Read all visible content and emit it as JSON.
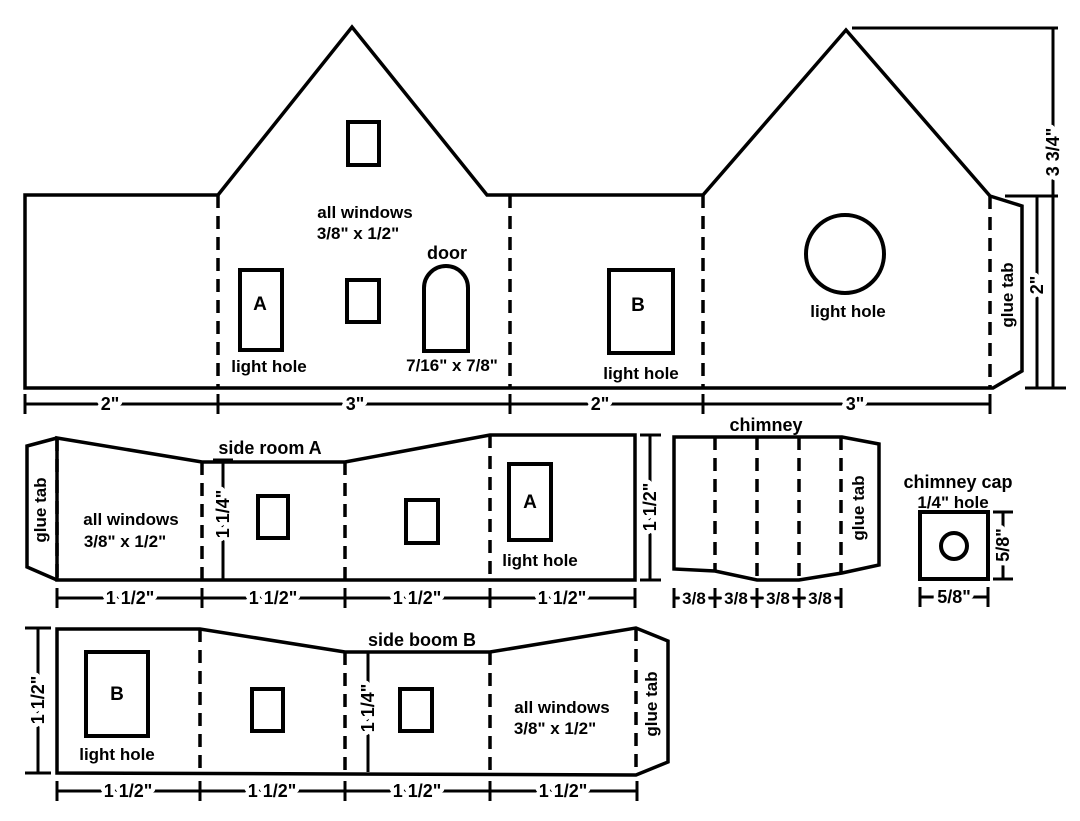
{
  "colors": {
    "line": "#000000",
    "background": "#ffffff"
  },
  "main_strip": {
    "window_note_line1": "all windows",
    "window_note_line2": "3/8\" x 1/2\"",
    "door_label": "door",
    "door_size": "7/16\" x 7/8\"",
    "hole_a_letter": "A",
    "hole_a_label": "light hole",
    "hole_b_letter": "B",
    "hole_b_label": "light hole",
    "back_hole_label": "light hole",
    "glue_tab_label": "glue tab",
    "width_dims": [
      "2\"",
      "3\"",
      "2\"",
      "3\""
    ],
    "wall_height_dim": "2\"",
    "total_height_dim": "3 3/4\""
  },
  "side_room_a": {
    "title": "side room A",
    "glue_tab_label": "glue tab",
    "window_note_line1": "all windows",
    "window_note_line2": "3/8\" x 1/2\"",
    "wall_height_dim": "1 1/4\"",
    "hole_letter": "A",
    "hole_label": "light hole",
    "width_dims": [
      "1 1/2\"",
      "1 1/2\"",
      "1 1/2\"",
      "1 1/2\""
    ],
    "height_dim": "1 1/2\""
  },
  "chimney": {
    "title": "chimney",
    "glue_tab_label": "glue tab",
    "width_dims": [
      "3/8",
      "3/8",
      "3/8",
      "3/8"
    ]
  },
  "chimney_cap": {
    "title": "chimney cap",
    "hole_note": "1/4\" hole",
    "width_dim": "5/8\"",
    "height_dim": "5/8\""
  },
  "side_room_b": {
    "title": "side boom B",
    "glue_tab_label": "glue tab",
    "window_note_line1": "all windows",
    "window_note_line2": "3/8\" x 1/2\"",
    "wall_height_dim": "1 1/4\"",
    "hole_letter": "B",
    "hole_label": "light hole",
    "width_dims": [
      "1 1/2\"",
      "1 1/2\"",
      "1 1/2\"",
      "1 1/2\""
    ],
    "height_dim": "1 1/2\""
  }
}
